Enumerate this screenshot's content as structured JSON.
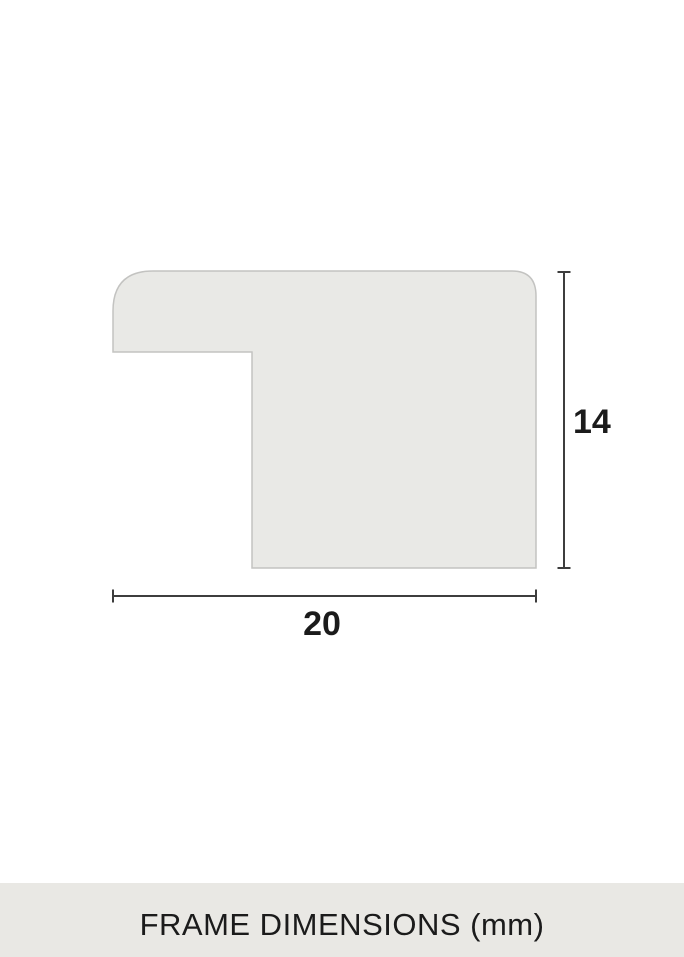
{
  "diagram": {
    "width_label": "20",
    "height_label": "14"
  },
  "footer": {
    "caption": "FRAME DIMENSIONS (mm)"
  },
  "colors": {
    "profile_fill": "#e9e9e6",
    "profile_stroke": "#c3c3c1",
    "dimension_line": "#3d3d3d",
    "label_text": "#1b1b1b",
    "footer_bg": "#e9e8e4",
    "footer_text": "#1b1b1b",
    "page_bg": "#ffffff"
  }
}
